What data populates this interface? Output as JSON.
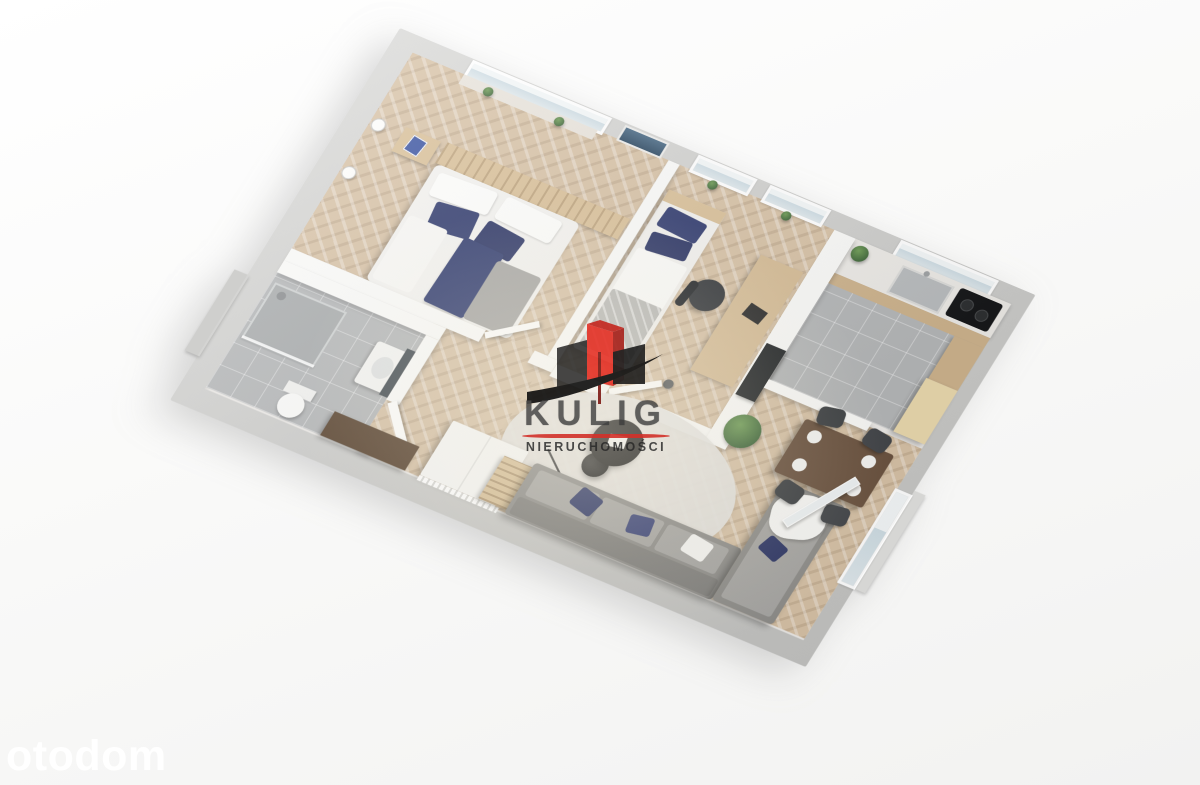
{
  "canvas": {
    "width": 1200,
    "height": 785,
    "background": "#f7f7f6"
  },
  "watermarks": {
    "agency": {
      "brand": "KULIG",
      "subtitle": "NIERUCHOMOŚCI",
      "logo_colors": {
        "building_red": "#e63227",
        "building_red_dark": "#a8211a",
        "building_dark": "#1c1c1c",
        "swoosh": "#0e0e0e",
        "underline_red": "#d3312a",
        "text": "#3c3c3c"
      }
    },
    "portal": {
      "label": "otodom",
      "color": "#ffffff"
    }
  },
  "floor_plan": {
    "style": "3D axonometric apartment render, rotated ~23deg",
    "colors": {
      "exterior_wall": "#c9c9c7",
      "interior_wall": "#fafaf8",
      "wood_floor": "#d7c2a6",
      "tile_floor": "#b5b7b8",
      "accent_navy": "#2f3a6d",
      "sofa_gray": "#8f8e8b",
      "dining_table_wood": "#6b5340",
      "wardrobe_brown": "#5b4531"
    },
    "rooms": [
      {
        "name": "bedroom",
        "furniture": [
          "double-bed",
          "white-pillows",
          "navy-pillows",
          "navy-runner",
          "gray-throw",
          "wood-headboard-panel",
          "nightstand",
          "wall-lamps",
          "window-with-plants",
          "wall-picture"
        ]
      },
      {
        "name": "second-bedroom",
        "furniture": [
          "single-bed",
          "navy-pillows",
          "gray-blanket",
          "desk",
          "office-chair",
          "floor-lamp",
          "two-windows-with-plants"
        ]
      },
      {
        "name": "kitchen",
        "furniture": [
          "counter",
          "sink",
          "faucet",
          "cooktop",
          "cabinet-fronts",
          "tall-cabinet",
          "plant",
          "window",
          "dark-appliance-panel"
        ]
      },
      {
        "name": "bathroom",
        "furniture": [
          "shower",
          "shower-head",
          "glass-screen",
          "toilet",
          "washbasin",
          "mirror",
          "door"
        ]
      },
      {
        "name": "hall",
        "furniture": [
          "brown-wardrobe"
        ]
      },
      {
        "name": "living-room",
        "furniture": [
          "corner-sofa",
          "navy-pillows",
          "white-blanket",
          "slat-side-table",
          "round-coffee-table",
          "round-rug",
          "arc-floor-lamp",
          "white-sideboard",
          "radiator",
          "dining-table",
          "four-chairs",
          "plates",
          "plant",
          "balcony-door",
          "balcony-railing"
        ]
      }
    ]
  }
}
